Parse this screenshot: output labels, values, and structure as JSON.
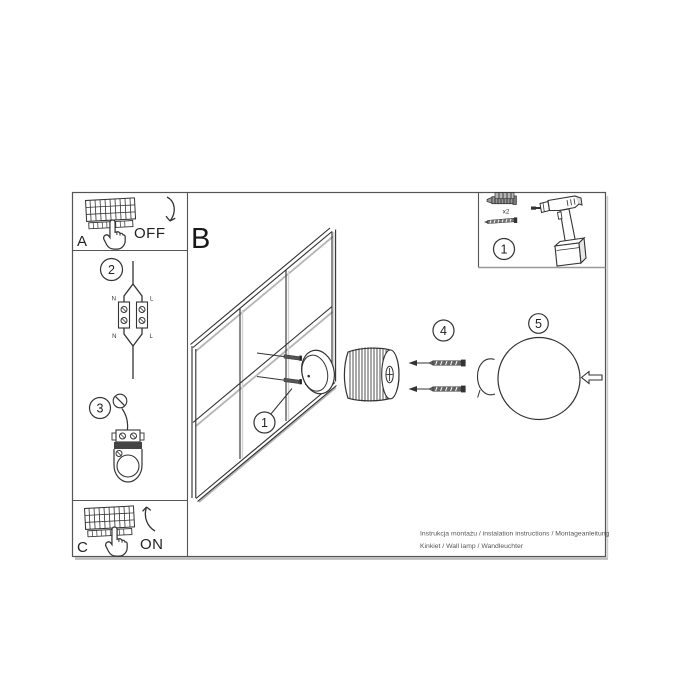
{
  "colors": {
    "line": "#333333",
    "shade": "#b5b5b5",
    "text": "#222222",
    "muted": "#555555"
  },
  "section": {
    "label": "B"
  },
  "panel_a": {
    "letter": "A",
    "switch_state": "OFF"
  },
  "panel_c": {
    "letter": "C",
    "switch_state": "ON"
  },
  "step2": {
    "number": "2",
    "labels": {
      "top_left": "N",
      "top_right": "L",
      "bottom_left": "N",
      "bottom_right": "L"
    }
  },
  "step3": {
    "number": "3"
  },
  "wall": {
    "callout": "1"
  },
  "step4": {
    "number": "4"
  },
  "step5": {
    "number": "5"
  },
  "tools": {
    "number": "1",
    "plug_count": "x2"
  },
  "footer": {
    "line1": "Instrukcja montażu / instalation instructions / Montageanleitung",
    "line2": "Kinkiet / Wall lamp / Wandleuchter"
  }
}
